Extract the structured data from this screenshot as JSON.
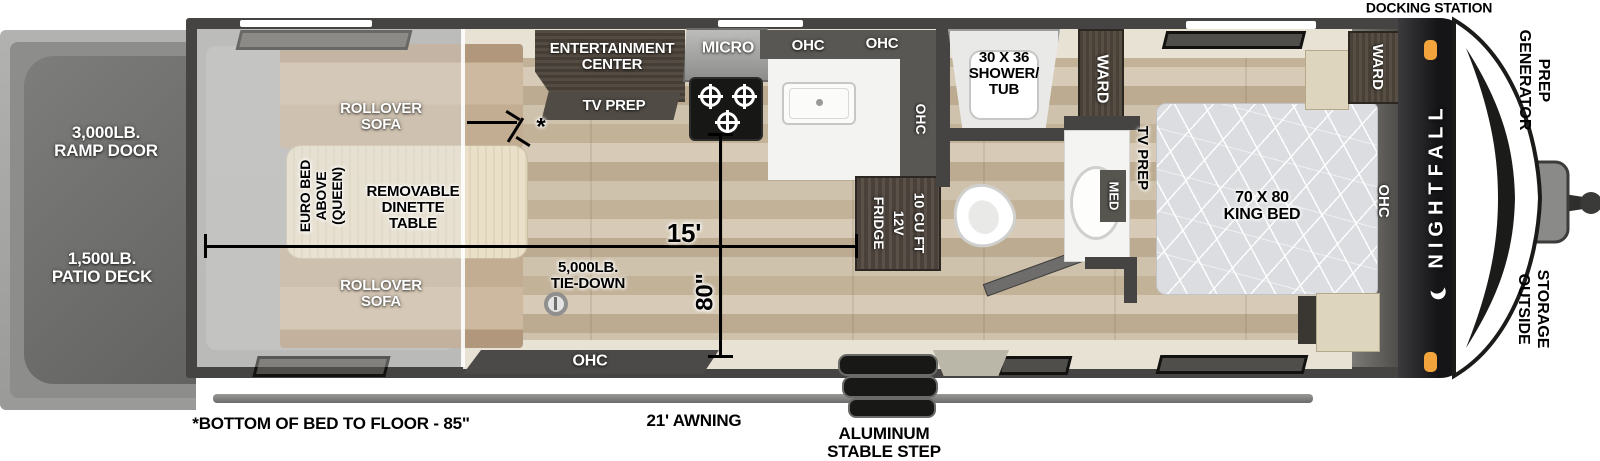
{
  "title": "Nightfall toy hauler travel trailer floor plan",
  "colors": {
    "wall": "#454442",
    "wood_floor": "#c9bba4",
    "garage_floor": "#a6a6a4",
    "sofa": "#c6b096",
    "table_cream": "#e9dfc8",
    "dark_cabinet": "#4e463c",
    "counter_white": "#f2f2f0",
    "bed_gray": "#dcdee0",
    "front_cap_black": "#1c1c1a",
    "marker_light_orange": "#f2a33c",
    "cream_trim": "#e7e2d3"
  },
  "labels": {
    "docking_station": "DOCKING STATION",
    "generator_prep": "GENERATOR\nPREP",
    "outside_storage": "OUTSIDE\nSTORAGE",
    "brand": "NIGHTFALL",
    "ramp_door": "3,000LB.\nRAMP DOOR",
    "patio_deck": "1,500LB.\nPATIO DECK",
    "rollover_sofa": "ROLLOVER\nSOFA",
    "euro_bed": "EURO BED\nABOVE\n(QUEEN)",
    "dinette": "REMOVABLE\nDINETTE\nTABLE",
    "entertainment_center": "ENTERTAINMENT\nCENTER",
    "tv_prep": "TV PREP",
    "micro": "MICRO",
    "ohc": "OHC",
    "fridge": "10 CU FT\n12V\nFRIDGE",
    "shower": "30 X 36\nSHOWER/\nTUB",
    "ward": "WARD",
    "med": "MED",
    "king_bed": "70 X 80\nKING BED",
    "tie_down": "5,000LB.\nTIE-DOWN",
    "length_dim": "15'",
    "width_dim": "80\"",
    "asterisk": "*",
    "bed_height_note": "*BOTTOM OF BED TO FLOOR - 85\"",
    "awning": "21' AWNING",
    "step": "ALUMINUM\nSTABLE STEP"
  }
}
